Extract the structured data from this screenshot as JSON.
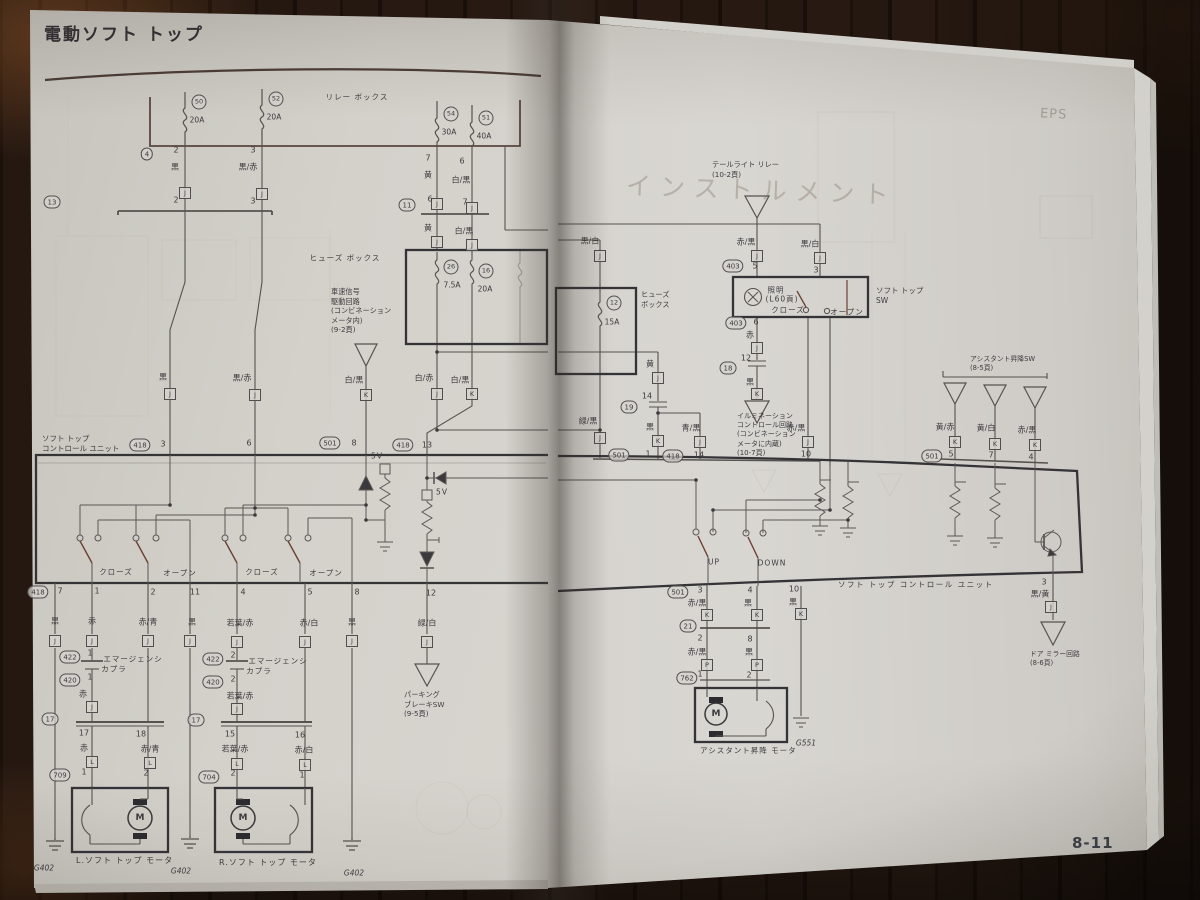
{
  "photo": {
    "page_number": "8-11"
  },
  "left_page": {
    "title": "電動ソフト トップ",
    "unit_label": "ソフト トップ\nコントロール ユニット",
    "speed_note": "車速信号\n駆動回路\n(コンビネーション\nメータ内)\n(9-2頁)",
    "parking_note": "パーキング\nブレーキSW\n(9-5頁)",
    "motor_left_label": "L.ソフト トップ モータ",
    "motor_right_label": "R.ソフト トップ モータ",
    "tags": [
      {
        "k": "t",
        "t": "リレー ボックス",
        "x": 357,
        "y": 97
      },
      {
        "k": "f",
        "t": "50",
        "x": 199,
        "y": 102
      },
      {
        "k": "a",
        "t": "20A",
        "x": 197,
        "y": 120
      },
      {
        "k": "f",
        "t": "52",
        "x": 276,
        "y": 99
      },
      {
        "k": "a",
        "t": "20A",
        "x": 274,
        "y": 117
      },
      {
        "k": "f",
        "t": "54",
        "x": 451,
        "y": 114
      },
      {
        "k": "a",
        "t": "30A",
        "x": 449,
        "y": 132
      },
      {
        "k": "f",
        "t": "51",
        "x": 486,
        "y": 118
      },
      {
        "k": "a",
        "t": "40A",
        "x": 484,
        "y": 136
      },
      {
        "k": "o",
        "t": "4",
        "x": 147,
        "y": 154
      },
      {
        "k": "p",
        "t": "2",
        "x": 176,
        "y": 150
      },
      {
        "k": "p",
        "t": "3",
        "x": 253,
        "y": 150
      },
      {
        "k": "p",
        "t": "7",
        "x": 428,
        "y": 158
      },
      {
        "k": "p",
        "t": "6",
        "x": 462,
        "y": 161
      },
      {
        "k": "c",
        "t": "黒",
        "x": 175,
        "y": 167
      },
      {
        "k": "c",
        "t": "黒/赤",
        "x": 248,
        "y": 167
      },
      {
        "k": "c",
        "t": "黄",
        "x": 428,
        "y": 175
      },
      {
        "k": "c",
        "t": "白/黒",
        "x": 461,
        "y": 180
      },
      {
        "k": "j",
        "t": "J",
        "x": 185,
        "y": 193
      },
      {
        "k": "j",
        "t": "J",
        "x": 262,
        "y": 194
      },
      {
        "k": "j",
        "t": "J",
        "x": 437,
        "y": 204
      },
      {
        "k": "j",
        "t": "J",
        "x": 472,
        "y": 208
      },
      {
        "k": "o",
        "t": "13",
        "x": 52,
        "y": 202
      },
      {
        "k": "p",
        "t": "2",
        "x": 176,
        "y": 200
      },
      {
        "k": "p",
        "t": "3",
        "x": 253,
        "y": 201
      },
      {
        "k": "o",
        "t": "11",
        "x": 407,
        "y": 205
      },
      {
        "k": "p",
        "t": "6",
        "x": 430,
        "y": 199
      },
      {
        "k": "p",
        "t": "7",
        "x": 465,
        "y": 202
      },
      {
        "k": "c",
        "t": "黄",
        "x": 428,
        "y": 228
      },
      {
        "k": "c",
        "t": "白/黒",
        "x": 464,
        "y": 231
      },
      {
        "k": "j",
        "t": "J",
        "x": 437,
        "y": 242
      },
      {
        "k": "j",
        "t": "J",
        "x": 472,
        "y": 245
      },
      {
        "k": "t",
        "t": "ヒューズ ボックス",
        "x": 345,
        "y": 258
      },
      {
        "k": "f",
        "t": "26",
        "x": 451,
        "y": 267
      },
      {
        "k": "a",
        "t": "7.5A",
        "x": 452,
        "y": 285
      },
      {
        "k": "f",
        "t": "16",
        "x": 486,
        "y": 271
      },
      {
        "k": "a",
        "t": "20A",
        "x": 485,
        "y": 289
      },
      {
        "k": "c",
        "t": "黒",
        "x": 163,
        "y": 377
      },
      {
        "k": "c",
        "t": "黒/赤",
        "x": 242,
        "y": 378
      },
      {
        "k": "c",
        "t": "白/黒",
        "x": 354,
        "y": 380
      },
      {
        "k": "c",
        "t": "白/赤",
        "x": 424,
        "y": 378
      },
      {
        "k": "c",
        "t": "白/黒",
        "x": 460,
        "y": 380
      },
      {
        "k": "j",
        "t": "J",
        "x": 170,
        "y": 394
      },
      {
        "k": "j",
        "t": "J",
        "x": 255,
        "y": 395
      },
      {
        "k": "j",
        "t": "K",
        "x": 366,
        "y": 395
      },
      {
        "k": "j",
        "t": "J",
        "x": 437,
        "y": 394
      },
      {
        "k": "j",
        "t": "K",
        "x": 472,
        "y": 394
      },
      {
        "k": "o",
        "t": "418",
        "x": 140,
        "y": 445
      },
      {
        "k": "p",
        "t": "3",
        "x": 163,
        "y": 444
      },
      {
        "k": "p",
        "t": "6",
        "x": 249,
        "y": 443
      },
      {
        "k": "o",
        "t": "501",
        "x": 330,
        "y": 443
      },
      {
        "k": "p",
        "t": "8",
        "x": 354,
        "y": 443
      },
      {
        "k": "o",
        "t": "418",
        "x": 403,
        "y": 445
      },
      {
        "k": "p",
        "t": "13",
        "x": 427,
        "y": 445
      },
      {
        "k": "t",
        "t": "5V",
        "x": 377,
        "y": 456
      },
      {
        "k": "t",
        "t": "5V",
        "x": 442,
        "y": 492
      },
      {
        "k": "t",
        "t": "クローズ",
        "x": 116,
        "y": 572
      },
      {
        "k": "t",
        "t": "オープン",
        "x": 180,
        "y": 573
      },
      {
        "k": "t",
        "t": "クローズ",
        "x": 262,
        "y": 572
      },
      {
        "k": "t",
        "t": "オープン",
        "x": 326,
        "y": 573
      },
      {
        "k": "o",
        "t": "418",
        "x": 38,
        "y": 592
      },
      {
        "k": "p",
        "t": "7",
        "x": 60,
        "y": 591
      },
      {
        "k": "p",
        "t": "1",
        "x": 97,
        "y": 591
      },
      {
        "k": "p",
        "t": "2",
        "x": 153,
        "y": 592
      },
      {
        "k": "p",
        "t": "11",
        "x": 195,
        "y": 592
      },
      {
        "k": "p",
        "t": "4",
        "x": 243,
        "y": 592
      },
      {
        "k": "p",
        "t": "5",
        "x": 310,
        "y": 592
      },
      {
        "k": "p",
        "t": "8",
        "x": 357,
        "y": 592
      },
      {
        "k": "p",
        "t": "12",
        "x": 431,
        "y": 593
      },
      {
        "k": "c",
        "t": "黒",
        "x": 55,
        "y": 621
      },
      {
        "k": "c",
        "t": "赤",
        "x": 92,
        "y": 621
      },
      {
        "k": "c",
        "t": "赤/青",
        "x": 148,
        "y": 622
      },
      {
        "k": "c",
        "t": "黒",
        "x": 192,
        "y": 622
      },
      {
        "k": "c",
        "t": "若葉/赤",
        "x": 240,
        "y": 623
      },
      {
        "k": "c",
        "t": "赤/白",
        "x": 309,
        "y": 623
      },
      {
        "k": "c",
        "t": "黒",
        "x": 352,
        "y": 622
      },
      {
        "k": "c",
        "t": "緑/白",
        "x": 427,
        "y": 623
      },
      {
        "k": "j",
        "t": "J",
        "x": 55,
        "y": 641
      },
      {
        "k": "j",
        "t": "J",
        "x": 92,
        "y": 641
      },
      {
        "k": "j",
        "t": "J",
        "x": 148,
        "y": 641
      },
      {
        "k": "j",
        "t": "J",
        "x": 190,
        "y": 641
      },
      {
        "k": "j",
        "t": "J",
        "x": 237,
        "y": 642
      },
      {
        "k": "j",
        "t": "J",
        "x": 305,
        "y": 642
      },
      {
        "k": "j",
        "t": "J",
        "x": 352,
        "y": 641
      },
      {
        "k": "j",
        "t": "J",
        "x": 427,
        "y": 642
      },
      {
        "k": "o",
        "t": "422",
        "x": 70,
        "y": 657
      },
      {
        "k": "p",
        "t": "1",
        "x": 90,
        "y": 653
      },
      {
        "k": "o",
        "t": "420",
        "x": 70,
        "y": 680
      },
      {
        "k": "p",
        "t": "1",
        "x": 90,
        "y": 677
      },
      {
        "k": "t",
        "t": "エマージェンシ",
        "x": 133,
        "y": 659
      },
      {
        "k": "t",
        "t": "カプラ",
        "x": 114,
        "y": 669
      },
      {
        "k": "c",
        "t": "赤",
        "x": 83,
        "y": 694
      },
      {
        "k": "j",
        "t": "J",
        "x": 92,
        "y": 707
      },
      {
        "k": "o",
        "t": "17",
        "x": 50,
        "y": 719
      },
      {
        "k": "p",
        "t": "17",
        "x": 84,
        "y": 733
      },
      {
        "k": "p",
        "t": "18",
        "x": 141,
        "y": 734
      },
      {
        "k": "c",
        "t": "赤",
        "x": 84,
        "y": 748
      },
      {
        "k": "c",
        "t": "赤/青",
        "x": 150,
        "y": 749
      },
      {
        "k": "j",
        "t": "L",
        "x": 92,
        "y": 762
      },
      {
        "k": "j",
        "t": "L",
        "x": 150,
        "y": 763
      },
      {
        "k": "o",
        "t": "709",
        "x": 60,
        "y": 775
      },
      {
        "k": "p",
        "t": "1",
        "x": 84,
        "y": 772
      },
      {
        "k": "p",
        "t": "2",
        "x": 146,
        "y": 773
      },
      {
        "k": "o",
        "t": "422",
        "x": 213,
        "y": 659
      },
      {
        "k": "p",
        "t": "2",
        "x": 233,
        "y": 655
      },
      {
        "k": "o",
        "t": "420",
        "x": 213,
        "y": 682
      },
      {
        "k": "p",
        "t": "2",
        "x": 233,
        "y": 679
      },
      {
        "k": "t",
        "t": "エマージェンシ",
        "x": 278,
        "y": 661
      },
      {
        "k": "t",
        "t": "カプラ",
        "x": 259,
        "y": 671
      },
      {
        "k": "c",
        "t": "若葉/赤",
        "x": 240,
        "y": 696
      },
      {
        "k": "j",
        "t": "J",
        "x": 237,
        "y": 709
      },
      {
        "k": "o",
        "t": "17",
        "x": 196,
        "y": 720
      },
      {
        "k": "p",
        "t": "15",
        "x": 230,
        "y": 734
      },
      {
        "k": "p",
        "t": "16",
        "x": 300,
        "y": 735
      },
      {
        "k": "c",
        "t": "若葉/赤",
        "x": 235,
        "y": 749
      },
      {
        "k": "c",
        "t": "赤/白",
        "x": 304,
        "y": 750
      },
      {
        "k": "j",
        "t": "L",
        "x": 237,
        "y": 764
      },
      {
        "k": "j",
        "t": "L",
        "x": 305,
        "y": 765
      },
      {
        "k": "o",
        "t": "704",
        "x": 209,
        "y": 777
      },
      {
        "k": "p",
        "t": "2",
        "x": 233,
        "y": 773
      },
      {
        "k": "p",
        "t": "1",
        "x": 302,
        "y": 775
      },
      {
        "k": "m",
        "t": "M",
        "x": 140,
        "y": 818
      },
      {
        "k": "m",
        "t": "M",
        "x": 243,
        "y": 818
      },
      {
        "k": "g",
        "t": "G402",
        "x": 44,
        "y": 868
      },
      {
        "k": "g",
        "t": "G402",
        "x": 181,
        "y": 871
      },
      {
        "k": "g",
        "t": "G402",
        "x": 354,
        "y": 873
      }
    ]
  },
  "right_page": {
    "tail_relay_note": "テールライト リレー\n(10-2頁)",
    "fuse_box_label": "ヒューズ\nボックス",
    "soft_top_sw_label": "ソフト トップ\nSW",
    "illumination_note": "イルミネーション\nコントロール回路\n(コンビネーション\nメータに内蔵)\n(10-7頁)",
    "assist_sw_note": "アシスタント昇降SW\n(8-5頁)",
    "unit_label": "ソフト トップ コントロール ユニット",
    "assist_motor_label": "アシスタント昇降 モータ",
    "mirror_note": "ドア ミラー回路\n(8-6頁)",
    "ghost_header": "インストルメント",
    "ghost_corner": "EPS",
    "tags": [
      {
        "k": "c",
        "t": "赤/黒",
        "x": 746,
        "y": 242
      },
      {
        "k": "j",
        "t": "J",
        "x": 757,
        "y": 256
      },
      {
        "k": "o",
        "t": "403",
        "x": 733,
        "y": 266
      },
      {
        "k": "p",
        "t": "5",
        "x": 755,
        "y": 266
      },
      {
        "k": "c",
        "t": "黒/白",
        "x": 810,
        "y": 244
      },
      {
        "k": "j",
        "t": "J",
        "x": 820,
        "y": 258
      },
      {
        "k": "p",
        "t": "3",
        "x": 816,
        "y": 270
      },
      {
        "k": "t",
        "t": "照明",
        "x": 776,
        "y": 290
      },
      {
        "k": "t",
        "t": "(L60頁)",
        "x": 782,
        "y": 299
      },
      {
        "k": "t",
        "t": "クローズ",
        "x": 788,
        "y": 310
      },
      {
        "k": "t",
        "t": "オープン",
        "x": 847,
        "y": 312
      },
      {
        "k": "o",
        "t": "403",
        "x": 736,
        "y": 323
      },
      {
        "k": "p",
        "t": "6",
        "x": 756,
        "y": 322
      },
      {
        "k": "c",
        "t": "赤",
        "x": 750,
        "y": 335
      },
      {
        "k": "j",
        "t": "J",
        "x": 757,
        "y": 348
      },
      {
        "k": "p",
        "t": "12",
        "x": 746,
        "y": 358
      },
      {
        "k": "o",
        "t": "18",
        "x": 728,
        "y": 368
      },
      {
        "k": "c",
        "t": "黒",
        "x": 750,
        "y": 382
      },
      {
        "k": "j",
        "t": "K",
        "x": 757,
        "y": 394
      },
      {
        "k": "c",
        "t": "黒/白",
        "x": 590,
        "y": 241
      },
      {
        "k": "j",
        "t": "J",
        "x": 600,
        "y": 256
      },
      {
        "k": "f",
        "t": "12",
        "x": 614,
        "y": 303
      },
      {
        "k": "a",
        "t": "15A",
        "x": 612,
        "y": 322
      },
      {
        "k": "c",
        "t": "緑/黒",
        "x": 588,
        "y": 421
      },
      {
        "k": "j",
        "t": "J",
        "x": 600,
        "y": 438
      },
      {
        "k": "c",
        "t": "黄",
        "x": 650,
        "y": 364
      },
      {
        "k": "j",
        "t": "J",
        "x": 658,
        "y": 378
      },
      {
        "k": "p",
        "t": "14",
        "x": 647,
        "y": 396
      },
      {
        "k": "o",
        "t": "19",
        "x": 629,
        "y": 407
      },
      {
        "k": "c",
        "t": "黒",
        "x": 650,
        "y": 427
      },
      {
        "k": "j",
        "t": "K",
        "x": 658,
        "y": 441
      },
      {
        "k": "c",
        "t": "青/黒",
        "x": 691,
        "y": 428
      },
      {
        "k": "j",
        "t": "J",
        "x": 700,
        "y": 442
      },
      {
        "k": "c",
        "t": "赤/黒",
        "x": 796,
        "y": 428
      },
      {
        "k": "j",
        "t": "J",
        "x": 808,
        "y": 442
      },
      {
        "k": "p",
        "t": "10",
        "x": 806,
        "y": 454
      },
      {
        "k": "o",
        "t": "501",
        "x": 619,
        "y": 455
      },
      {
        "k": "p",
        "t": "1",
        "x": 648,
        "y": 454
      },
      {
        "k": "o",
        "t": "418",
        "x": 673,
        "y": 456
      },
      {
        "k": "p",
        "t": "14",
        "x": 699,
        "y": 455
      },
      {
        "k": "c",
        "t": "黄/赤",
        "x": 945,
        "y": 427
      },
      {
        "k": "c",
        "t": "黄/白",
        "x": 986,
        "y": 428
      },
      {
        "k": "c",
        "t": "赤/黒",
        "x": 1027,
        "y": 430
      },
      {
        "k": "j",
        "t": "K",
        "x": 955,
        "y": 442
      },
      {
        "k": "j",
        "t": "K",
        "x": 995,
        "y": 444
      },
      {
        "k": "j",
        "t": "K",
        "x": 1035,
        "y": 445
      },
      {
        "k": "o",
        "t": "501",
        "x": 932,
        "y": 456
      },
      {
        "k": "p",
        "t": "5",
        "x": 951,
        "y": 454
      },
      {
        "k": "p",
        "t": "7",
        "x": 991,
        "y": 455
      },
      {
        "k": "p",
        "t": "4",
        "x": 1031,
        "y": 457
      },
      {
        "k": "t",
        "t": "UP",
        "x": 714,
        "y": 562
      },
      {
        "k": "t",
        "t": "DOWN",
        "x": 772,
        "y": 563
      },
      {
        "k": "o",
        "t": "501",
        "x": 678,
        "y": 592
      },
      {
        "k": "p",
        "t": "3",
        "x": 700,
        "y": 590
      },
      {
        "k": "p",
        "t": "4",
        "x": 750,
        "y": 590
      },
      {
        "k": "p",
        "t": "10",
        "x": 794,
        "y": 589
      },
      {
        "k": "c",
        "t": "赤/黒",
        "x": 697,
        "y": 603
      },
      {
        "k": "c",
        "t": "黒",
        "x": 748,
        "y": 603
      },
      {
        "k": "c",
        "t": "黒",
        "x": 793,
        "y": 602
      },
      {
        "k": "j",
        "t": "K",
        "x": 707,
        "y": 615
      },
      {
        "k": "j",
        "t": "K",
        "x": 757,
        "y": 615
      },
      {
        "k": "j",
        "t": "K",
        "x": 801,
        "y": 614
      },
      {
        "k": "o",
        "t": "21",
        "x": 688,
        "y": 626
      },
      {
        "k": "p",
        "t": "2",
        "x": 700,
        "y": 638
      },
      {
        "k": "p",
        "t": "8",
        "x": 750,
        "y": 639
      },
      {
        "k": "c",
        "t": "赤/黒",
        "x": 697,
        "y": 652
      },
      {
        "k": "c",
        "t": "黒",
        "x": 749,
        "y": 652
      },
      {
        "k": "j",
        "t": "P",
        "x": 707,
        "y": 665
      },
      {
        "k": "j",
        "t": "P",
        "x": 757,
        "y": 665
      },
      {
        "k": "o",
        "t": "762",
        "x": 687,
        "y": 678
      },
      {
        "k": "p",
        "t": "1",
        "x": 700,
        "y": 674
      },
      {
        "k": "p",
        "t": "2",
        "x": 749,
        "y": 675
      },
      {
        "k": "m",
        "t": "M",
        "x": 716,
        "y": 714
      },
      {
        "k": "g",
        "t": "G551",
        "x": 806,
        "y": 743
      },
      {
        "k": "p",
        "t": "3",
        "x": 1044,
        "y": 582
      },
      {
        "k": "c",
        "t": "黒/黄",
        "x": 1040,
        "y": 594
      },
      {
        "k": "j",
        "t": "J",
        "x": 1051,
        "y": 607
      }
    ]
  }
}
